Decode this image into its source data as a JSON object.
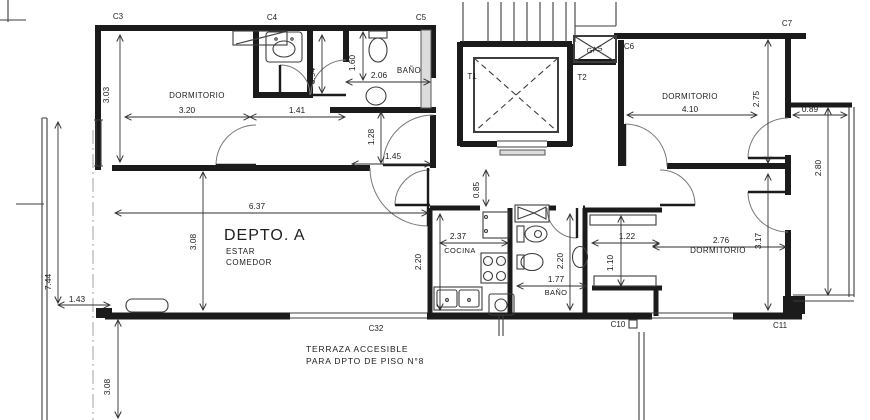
{
  "plan": {
    "colors": {
      "ink": "#1b1b1b",
      "thin": "#3d3d3d",
      "dim": "#2f2f2f",
      "bg": "#ffffff",
      "gray": "#dcdcdc"
    },
    "apartment_title": "DEPTO. A",
    "labels": [
      {
        "id": "room-dormitorio-1",
        "text": "DORMITORIO",
        "x": 197,
        "y": 98,
        "size": 8,
        "ls": 0.4
      },
      {
        "id": "room-banio-1",
        "text": "BAÑO",
        "x": 409,
        "y": 73,
        "size": 8,
        "ls": 0.4
      },
      {
        "id": "room-dormitorio-2",
        "text": "DORMITORIO",
        "x": 690,
        "y": 99,
        "size": 8,
        "ls": 0.4
      },
      {
        "id": "apartment-title",
        "text": "DEPTO. A",
        "x": 224,
        "y": 240,
        "size": 16,
        "anchor": "start",
        "ls": 1
      },
      {
        "id": "room-estar",
        "text": "ESTAR",
        "x": 226,
        "y": 254,
        "size": 8,
        "anchor": "start",
        "ls": 0.6
      },
      {
        "id": "room-comedor",
        "text": "COMEDOR",
        "x": 226,
        "y": 265,
        "size": 8,
        "anchor": "start",
        "ls": 0.6
      },
      {
        "id": "room-cocina",
        "text": "COCINA",
        "x": 460,
        "y": 253,
        "size": 7.5,
        "ls": 0.4
      },
      {
        "id": "room-banio-2",
        "text": "BAÑO",
        "x": 556,
        "y": 295,
        "size": 7.5,
        "ls": 0.4
      },
      {
        "id": "room-dormitorio-3",
        "text": "DORMITORIO",
        "x": 718,
        "y": 253,
        "size": 8,
        "ls": 0.4
      },
      {
        "id": "terrace-note-line-1",
        "text": "TERRAZA ACCESIBLE",
        "x": 306,
        "y": 352,
        "size": 8.5,
        "anchor": "start",
        "ls": 0.8
      },
      {
        "id": "terrace-note-line-2",
        "text": "PARA DPTO DE PISO N°8",
        "x": 306,
        "y": 364,
        "size": 8.5,
        "anchor": "start",
        "ls": 0.8
      },
      {
        "id": "ref-c3",
        "text": "C3",
        "x": 118,
        "y": 19,
        "size": 8
      },
      {
        "id": "ref-c4",
        "text": "C4",
        "x": 272,
        "y": 20,
        "size": 8
      },
      {
        "id": "ref-c5",
        "text": "C5",
        "x": 421,
        "y": 20,
        "size": 8
      },
      {
        "id": "ref-c6",
        "text": "C6",
        "x": 629,
        "y": 49,
        "size": 8
      },
      {
        "id": "ref-c7",
        "text": "C7",
        "x": 787,
        "y": 26,
        "size": 8
      },
      {
        "id": "ref-c8",
        "text": "C8",
        "x": 101,
        "y": 318,
        "size": 8
      },
      {
        "id": "ref-c32",
        "text": "C32",
        "x": 376,
        "y": 331,
        "size": 8
      },
      {
        "id": "ref-c10",
        "text": "C10",
        "x": 618,
        "y": 327,
        "size": 8
      },
      {
        "id": "ref-c11",
        "text": "C11",
        "x": 780,
        "y": 328,
        "size": 8
      },
      {
        "id": "ref-t1",
        "text": "T1",
        "x": 472,
        "y": 79,
        "size": 8
      },
      {
        "id": "ref-t2",
        "text": "T2",
        "x": 582,
        "y": 80,
        "size": 8
      },
      {
        "id": "ref-gas",
        "text": "GAS",
        "x": 595,
        "y": 52,
        "size": 7.5,
        "rot": -12
      },
      {
        "id": "dim-3-03",
        "text": "3.03",
        "x": 109,
        "y": 95,
        "rot": -90
      },
      {
        "id": "dim-3-20",
        "text": "3.20",
        "x": 187,
        "y": 113
      },
      {
        "id": "dim-1-41",
        "text": "1.41",
        "x": 297,
        "y": 113
      },
      {
        "id": "dim-0-94",
        "text": "0.94",
        "x": 315,
        "y": 76,
        "rot": -90
      },
      {
        "id": "dim-1-60",
        "text": "1.60",
        "x": 355,
        "y": 63,
        "rot": -90
      },
      {
        "id": "dim-2-06",
        "text": "2.06",
        "x": 379,
        "y": 78
      },
      {
        "id": "dim-1-28",
        "text": "1.28",
        "x": 374,
        "y": 137,
        "rot": -90
      },
      {
        "id": "dim-1-45",
        "text": "1.45",
        "x": 393,
        "y": 159
      },
      {
        "id": "dim-0-85",
        "text": "0.85",
        "x": 479,
        "y": 190,
        "rot": -90
      },
      {
        "id": "dim-6-37",
        "text": "6.37",
        "x": 257,
        "y": 209
      },
      {
        "id": "dim-3-08-estar",
        "text": "3.08",
        "x": 196,
        "y": 242,
        "rot": -90
      },
      {
        "id": "dim-4-10",
        "text": "4.10",
        "x": 690,
        "y": 112
      },
      {
        "id": "dim-2-75",
        "text": "2.75",
        "x": 759,
        "y": 99,
        "rot": -90
      },
      {
        "id": "dim-0-89",
        "text": "0.89",
        "x": 810,
        "y": 112
      },
      {
        "id": "dim-2-80",
        "text": "2.80",
        "x": 821,
        "y": 168,
        "rot": -90
      },
      {
        "id": "dim-2-37",
        "text": "2.37",
        "x": 458,
        "y": 239
      },
      {
        "id": "dim-2-20-cocina",
        "text": "2.20",
        "x": 421,
        "y": 262,
        "rot": -90
      },
      {
        "id": "dim-1-77",
        "text": "1.77",
        "x": 556,
        "y": 282
      },
      {
        "id": "dim-2-20-banio",
        "text": "2.20",
        "x": 563,
        "y": 261,
        "rot": -90
      },
      {
        "id": "dim-1-22",
        "text": "1.22",
        "x": 627,
        "y": 239
      },
      {
        "id": "dim-1-10",
        "text": "1.10",
        "x": 613,
        "y": 263,
        "rot": -90
      },
      {
        "id": "dim-2-76",
        "text": "2.76",
        "x": 721,
        "y": 243
      },
      {
        "id": "dim-3-17",
        "text": "3.17",
        "x": 761,
        "y": 241,
        "rot": -90
      },
      {
        "id": "dim-7-44",
        "text": "7.44",
        "x": 51,
        "y": 282,
        "rot": -90
      },
      {
        "id": "dim-1-43",
        "text": "1.43",
        "x": 77,
        "y": 302
      },
      {
        "id": "dim-3-08-terraza",
        "text": "3.08",
        "x": 110,
        "y": 387,
        "rot": -90
      }
    ]
  }
}
